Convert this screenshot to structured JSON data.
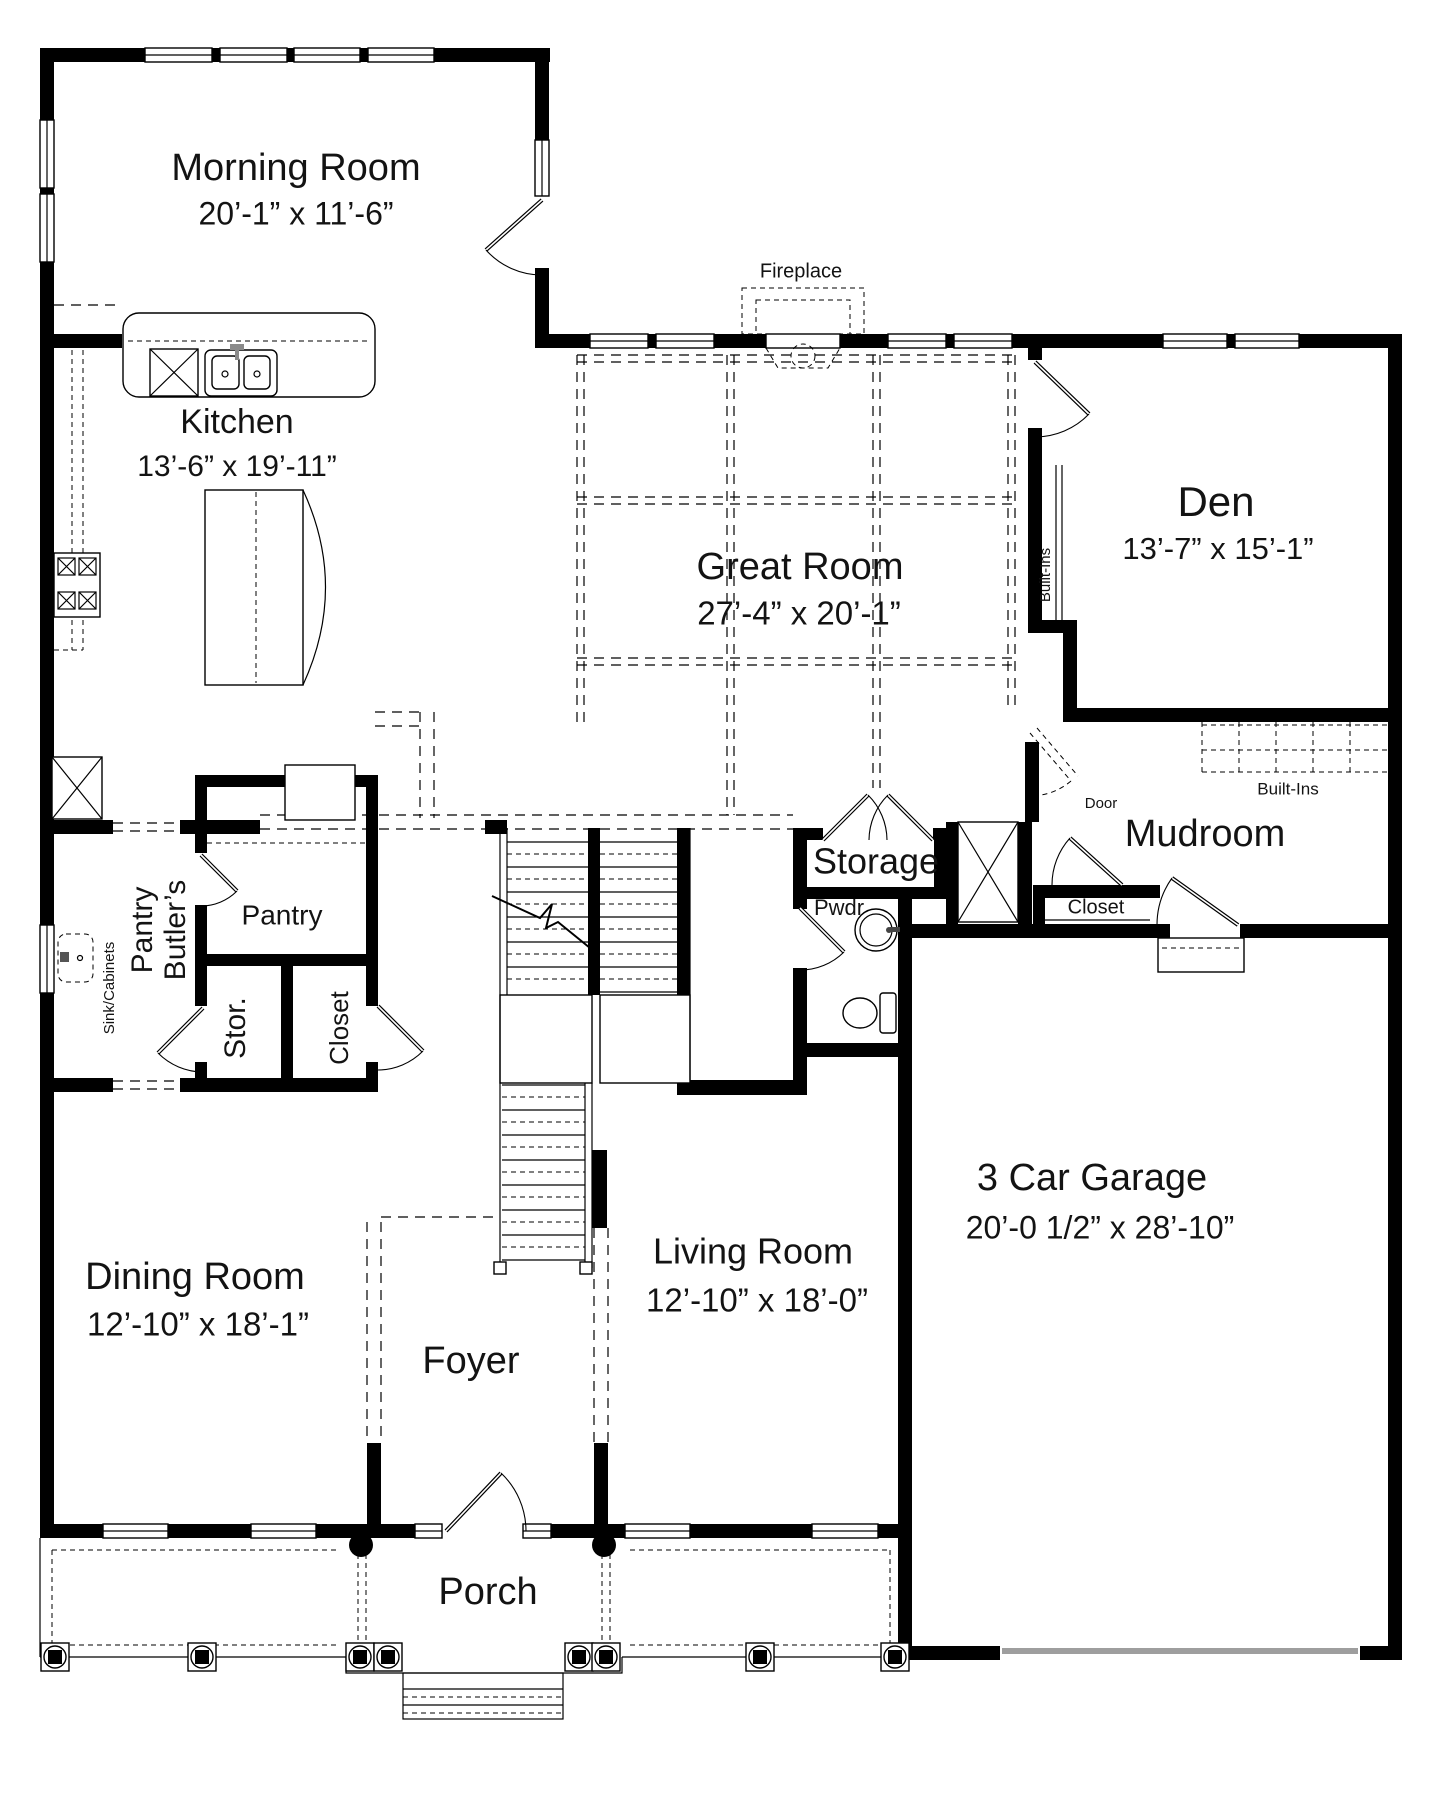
{
  "colors": {
    "wall": "#000000",
    "line": "#131313",
    "garage_door": "#9e9e9e",
    "background": "#ffffff"
  },
  "rooms": [
    {
      "id": "morning_room",
      "name": "Morning Room",
      "dims": "20’-1” x 11’-6”"
    },
    {
      "id": "kitchen",
      "name": "Kitchen",
      "dims": "13’-6” x 19’-11”"
    },
    {
      "id": "great_room",
      "name": "Great Room",
      "dims": "27’-4” x 20’-1”"
    },
    {
      "id": "den",
      "name": "Den",
      "dims": "13’-7” x 15’-1”"
    },
    {
      "id": "mudroom",
      "name": "Mudroom"
    },
    {
      "id": "storage",
      "name": "Storage"
    },
    {
      "id": "powder_room",
      "name": "Pwdr"
    },
    {
      "id": "butlers_pantry",
      "line1": "Butler’s",
      "line2": "Pantry"
    },
    {
      "id": "pantry",
      "name": "Pantry"
    },
    {
      "id": "stor_closet",
      "name": "Stor."
    },
    {
      "id": "hall_closet",
      "name": "Closet"
    },
    {
      "id": "dining_room",
      "name": "Dining Room",
      "dims": "12’-10” x 18’-1”"
    },
    {
      "id": "foyer",
      "name": "Foyer"
    },
    {
      "id": "living_room",
      "name": "Living Room",
      "dims": "12’-10” x 18’-0”"
    },
    {
      "id": "garage",
      "name": "3 Car Garage",
      "dims": "20’-0 1/2” x 28’-10”"
    },
    {
      "id": "porch",
      "name": "Porch"
    },
    {
      "id": "mudroom_closet",
      "name": "Closet"
    }
  ],
  "annotations": {
    "fireplace": "Fireplace",
    "den_built_ins": "Built-Ins",
    "mudroom_built_ins": "Built-Ins",
    "mudroom_door": "Door",
    "sink_cabinets": "Sink/Cabinets"
  }
}
